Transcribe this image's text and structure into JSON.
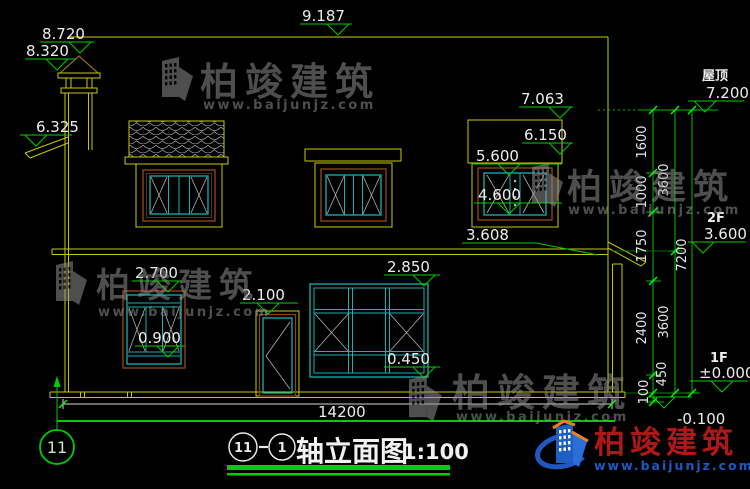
{
  "drawing_title": {
    "axis_from": "11",
    "axis_to": "1",
    "name": "轴立面图",
    "scale": "1:100"
  },
  "axis_bubble_label": "11",
  "levels": {
    "ridge": "9.187",
    "chimney_cap": "8.720",
    "chimney_shoulder": "8.320",
    "eave_left": "6.325",
    "roof_label": "屋顶",
    "roof": "7.200",
    "dormer_top": "7.063",
    "dormer_eave": "6.150",
    "win2f_head": "5.600",
    "win2f_sill": "4.600",
    "eave_right": "3.608",
    "floor2_label": "2F",
    "floor2": "3.600",
    "floor1_label": "1F",
    "floor1": "±0.000",
    "grade": "-0.100",
    "win1f_left_head": "2.700",
    "win1f_left_sill": "0.900",
    "door_head": "2.100",
    "win1f_mid_head": "2.850",
    "win1f_mid_sill": "0.450"
  },
  "dimensions": {
    "right_inner": [
      "1600",
      "1000",
      "1750",
      "2400",
      "450",
      "100"
    ],
    "right_middle": [
      "3600",
      "3600"
    ],
    "right_outer": "7200",
    "total_width": "14200"
  },
  "watermark": {
    "brand": "柏竣建筑",
    "url": "www.baijunjz.com"
  },
  "colors": {
    "line_yellow": "#c8c800",
    "marker_green": "#00cc00",
    "frame_cyan": "#18b0b0",
    "frame_brown": "#8a4513",
    "text_white": "#e8e8e8",
    "brand_red": "#b01818",
    "brand_blue": "#1f58c0",
    "brand_orange": "#f08018"
  }
}
